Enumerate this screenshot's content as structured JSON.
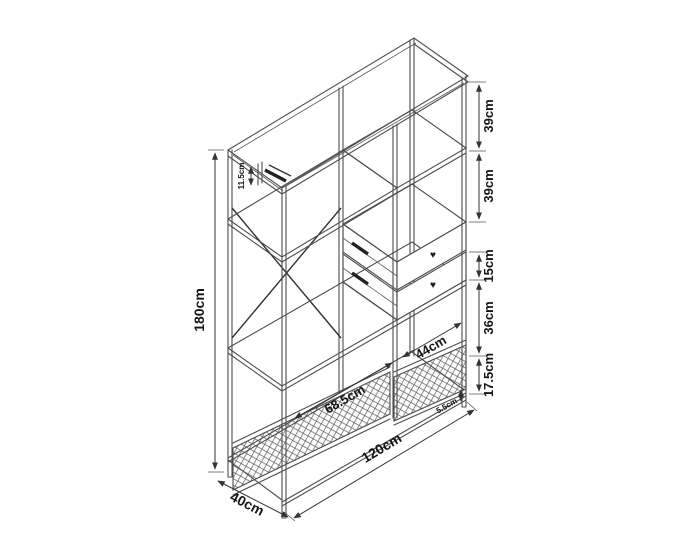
{
  "diagram": {
    "dimensions": {
      "height": {
        "label": "180cm"
      },
      "width": {
        "label": "120cm"
      },
      "depth": {
        "label": "40cm"
      },
      "left_section_width": {
        "label": "68.5cm"
      },
      "right_section_width": {
        "label": "44cm"
      },
      "hook_drop": {
        "label": "11.5cm"
      },
      "basket_edge": {
        "label": "5.5cm"
      },
      "right_column_segments": [
        {
          "label": "39cm"
        },
        {
          "label": "39cm"
        },
        {
          "label": "15cm"
        },
        {
          "label": "36cm"
        },
        {
          "label": "17.5cm"
        }
      ]
    },
    "icons": {
      "heart_knob": "♥"
    },
    "colors": {
      "line": "#4d4d4d",
      "dim_line": "#333333",
      "label": "#151515",
      "background": "#ffffff"
    }
  }
}
